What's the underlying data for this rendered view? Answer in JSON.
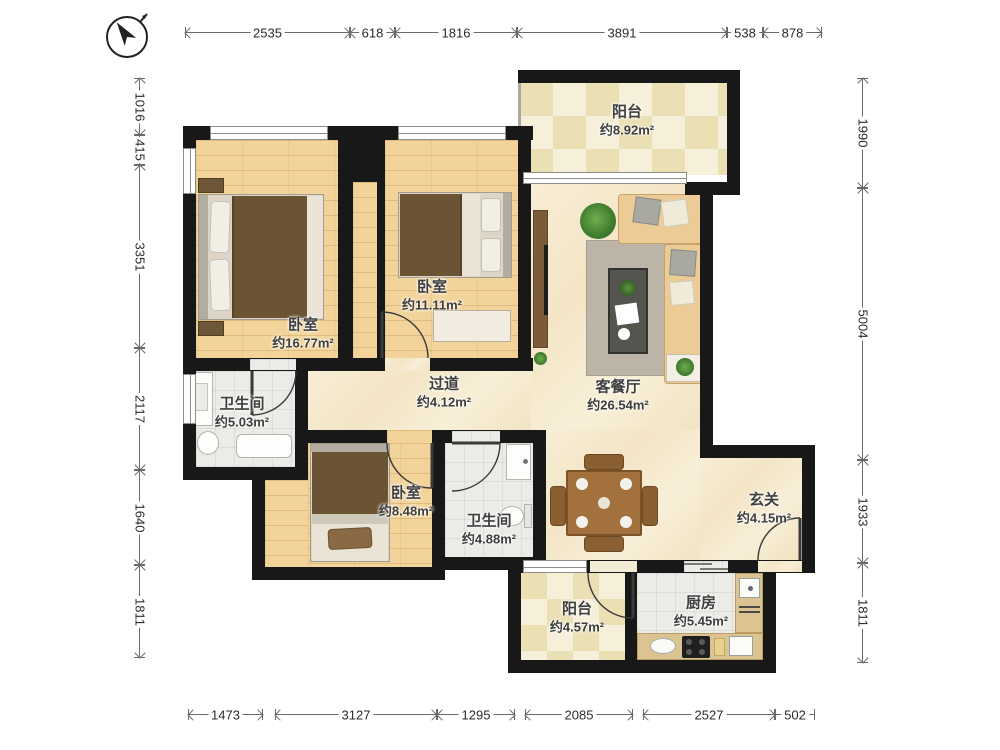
{
  "rooms": {
    "balcony_top": {
      "name": "阳台",
      "area": "约8.92m²"
    },
    "bedroom_left": {
      "name": "卧室",
      "area": "约16.77m²"
    },
    "bedroom_mid": {
      "name": "卧室",
      "area": "约11.11m²"
    },
    "bath_left": {
      "name": "卫生间",
      "area": "约5.03m²"
    },
    "hallway": {
      "name": "过道",
      "area": "约4.12m²"
    },
    "living": {
      "name": "客餐厅",
      "area": "约26.54m²"
    },
    "bedroom_small": {
      "name": "卧室",
      "area": "约8.48m²"
    },
    "bath_mid": {
      "name": "卫生间",
      "area": "约4.88m²"
    },
    "entry": {
      "name": "玄关",
      "area": "约4.15m²"
    },
    "balcony_bottom": {
      "name": "阳台",
      "area": "约4.57m²"
    },
    "kitchen": {
      "name": "厨房",
      "area": "约5.45m²"
    }
  },
  "dims": {
    "top": [
      "2535",
      "618",
      "1816",
      "3891",
      "538",
      "878"
    ],
    "left": [
      "1016",
      "415",
      "3351",
      "2117",
      "1640",
      "1811"
    ],
    "right": [
      "1990",
      "5004",
      "1933",
      "1811"
    ],
    "bottom": [
      "1473",
      "3127",
      "1295",
      "2085",
      "2527",
      "502"
    ]
  },
  "colors": {
    "wall": "#181818",
    "wood_floor": "#f2d49b",
    "marble_floor": "#f3e5c5",
    "tile_floor": "#ebebe7",
    "blanket": "#6b5434",
    "sofa": "#eccb97",
    "counter": "#dcc492"
  },
  "icons": {
    "compass": "north-arrow-icon"
  }
}
